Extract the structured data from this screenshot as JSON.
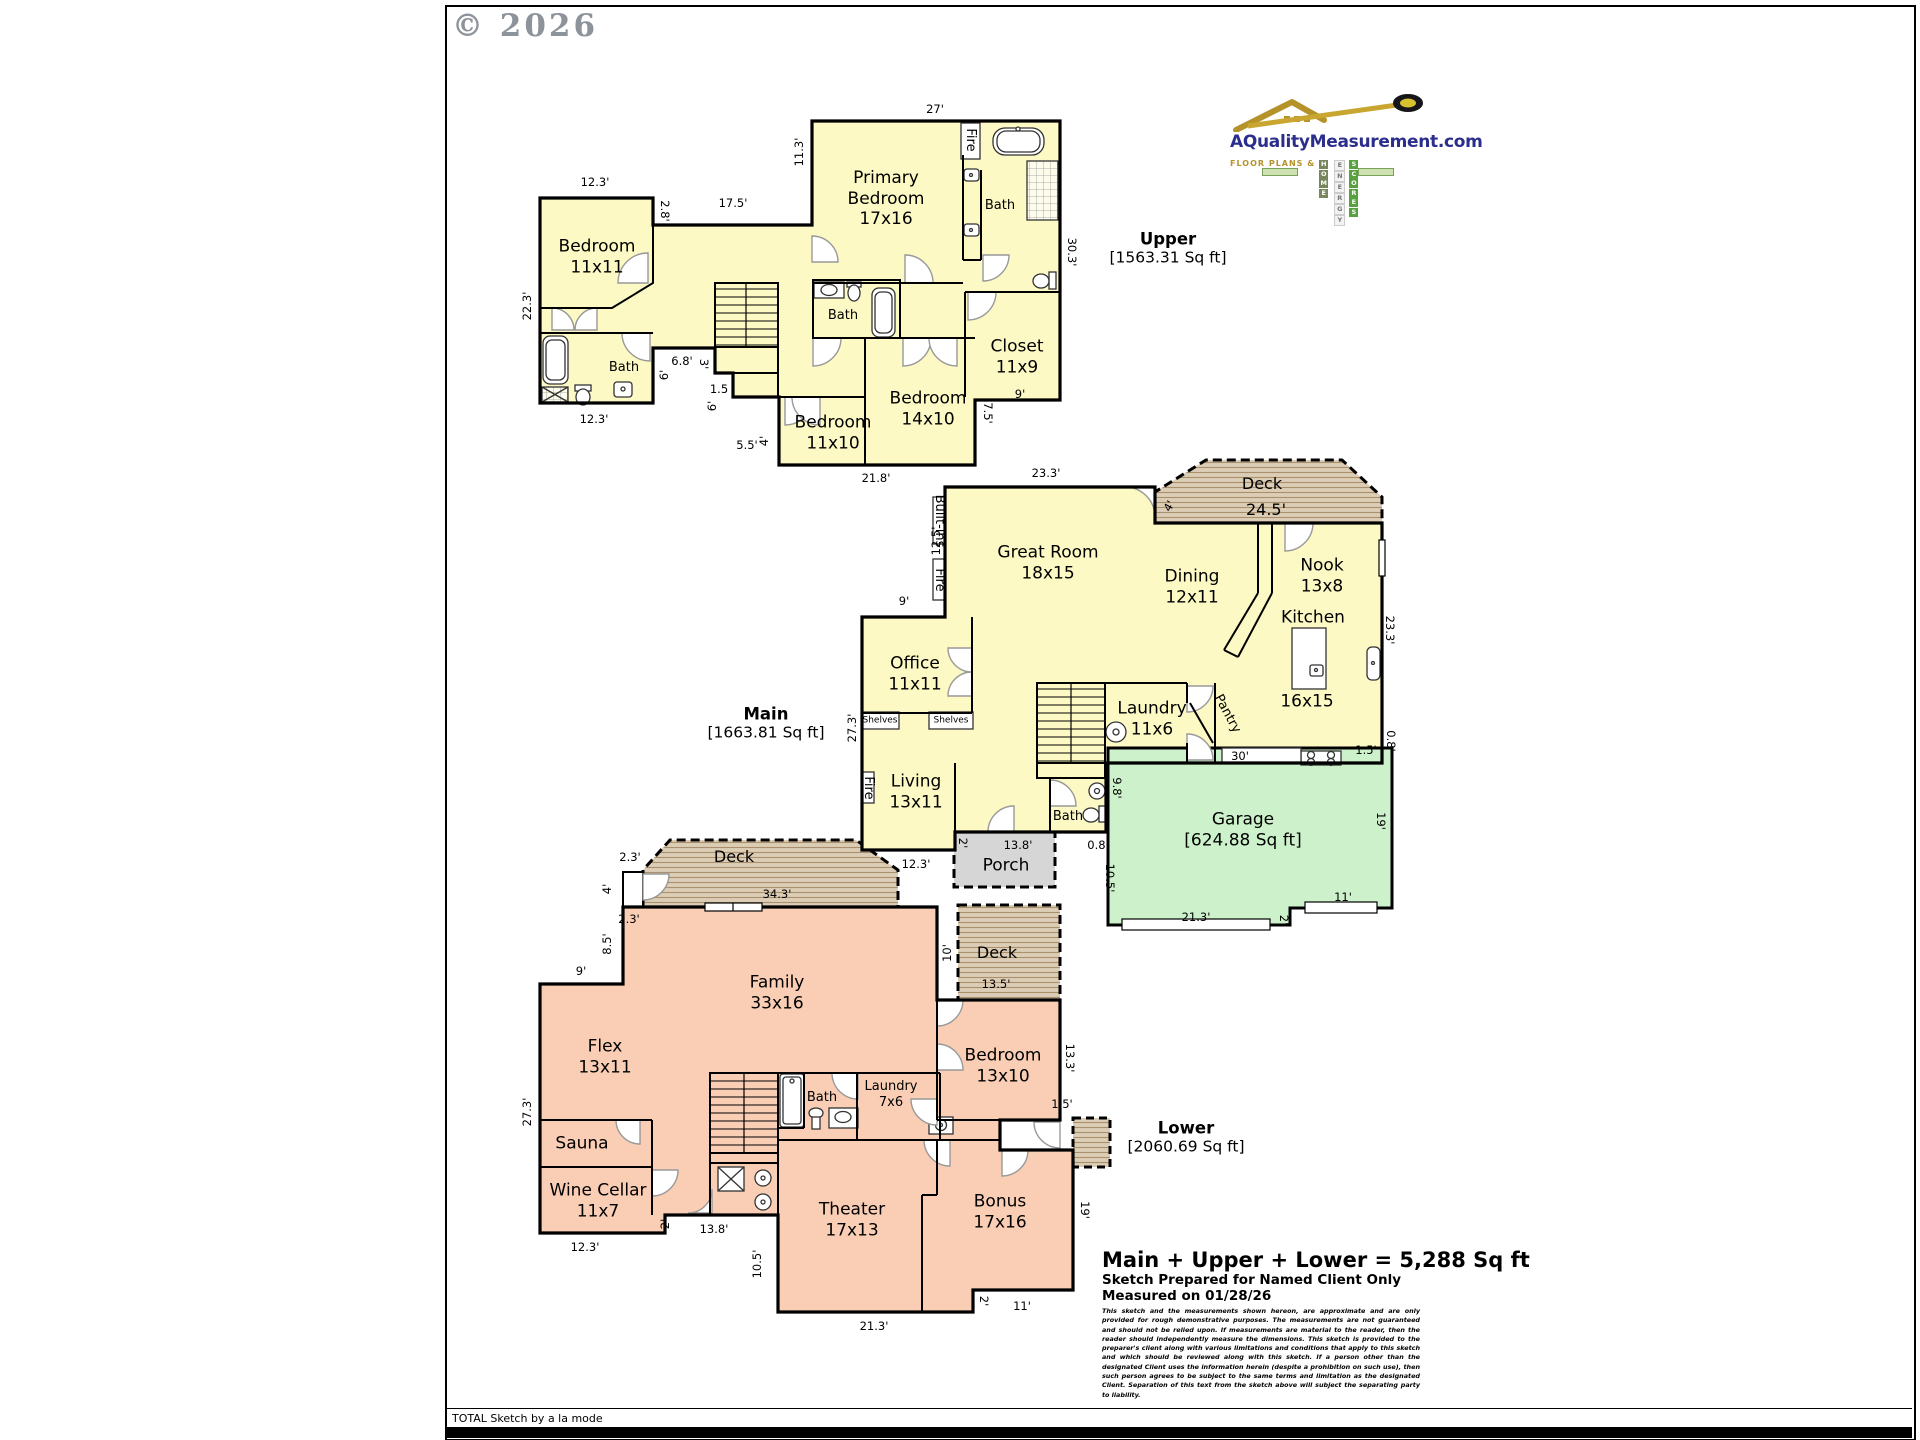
{
  "page": {
    "copyright": "© 2026",
    "footer": "TOTAL Sketch by a la mode"
  },
  "logo": {
    "domain": "AQualityMeasurement.com",
    "tagline": "Floor Plans &",
    "words": [
      "Home",
      "Energy",
      "Scores"
    ]
  },
  "floors": [
    {
      "name": "Upper",
      "area": "[1563.31 Sq ft]"
    },
    {
      "name": "Main",
      "area": "[1663.81 Sq ft]"
    },
    {
      "name": "Lower",
      "area": "[2060.69 Sq ft]"
    }
  ],
  "summary": {
    "total": "Main + Upper + Lower = 5,288 Sq ft",
    "prepared": "Sketch Prepared for Named Client Only",
    "measured": "Measured on 01/28/26",
    "disclaimer": "This sketch and the measurements shown hereon, are approximate and are only provided for rough demonstrative purposes.  The measurements are not guaranteed and should not be relied upon.  If measurements are material to the reader, then the reader should independently measure the dimensions.  This sketch is provided to the preparer's client along with various limitations and conditions that apply to this sketch and which should be reviewed along with this sketch.  If a person other than the designated Client uses the information herein (despite a prohibition on such use), then such person agrees to be subject to the same terms and limitation as the designated Client.  Separation of this text from the sketch above will subject the separating party to liability."
  },
  "colors": {
    "upper_main_fill": "#FCF9C4",
    "lower_fill": "#F9CEB5",
    "garage_fill": "#CDF2CB",
    "porch_fill": "#D6D6D6",
    "deck_fill": "#DCCDB6"
  },
  "labels": {
    "rooms": [
      {
        "t": "Bedroom\n11x11",
        "x": 597,
        "y": 257
      },
      {
        "t": "Primary\nBedroom\n17x16",
        "x": 886,
        "y": 199
      },
      {
        "t": "Closet\n11x9",
        "x": 1017,
        "y": 357
      },
      {
        "t": "Bedroom\n14x10",
        "x": 928,
        "y": 409
      },
      {
        "t": "Bedroom\n11x10",
        "x": 833,
        "y": 433
      },
      {
        "t": "Great Room\n18x15",
        "x": 1048,
        "y": 563
      },
      {
        "t": "Dining\n12x11",
        "x": 1192,
        "y": 587
      },
      {
        "t": "Nook\n13x8",
        "x": 1322,
        "y": 576
      },
      {
        "t": "Kitchen",
        "x": 1313,
        "y": 618
      },
      {
        "t": "16x15",
        "x": 1307,
        "y": 702
      },
      {
        "t": "Office\n11x11",
        "x": 915,
        "y": 674
      },
      {
        "t": "Laundry\n11x6",
        "x": 1152,
        "y": 719
      },
      {
        "t": "Living\n13x11",
        "x": 916,
        "y": 792
      },
      {
        "t": "Garage\n[624.88 Sq ft]",
        "x": 1243,
        "y": 830
      },
      {
        "t": "Family\n33x16",
        "x": 777,
        "y": 993
      },
      {
        "t": "Flex\n13x11",
        "x": 605,
        "y": 1057
      },
      {
        "t": "Sauna",
        "x": 582,
        "y": 1144
      },
      {
        "t": "Wine Cellar\n11x7",
        "x": 598,
        "y": 1201
      },
      {
        "t": "Theater\n17x13",
        "x": 852,
        "y": 1220
      },
      {
        "t": "Bonus\n17x16",
        "x": 1000,
        "y": 1212
      },
      {
        "t": "Bedroom\n13x10",
        "x": 1003,
        "y": 1066
      },
      {
        "t": "Deck",
        "x": 1262,
        "y": 484,
        "cls": "deckl"
      },
      {
        "t": "24.5'",
        "x": 1266,
        "y": 510,
        "cls": "deckl"
      },
      {
        "t": "Deck",
        "x": 734,
        "y": 857,
        "cls": "deckl"
      },
      {
        "t": "Deck",
        "x": 997,
        "y": 953,
        "cls": "deckl"
      },
      {
        "t": "Porch",
        "x": 1006,
        "y": 866
      }
    ],
    "feats": [
      {
        "t": "Bath",
        "x": 624,
        "y": 368
      },
      {
        "t": "Bath",
        "x": 843,
        "y": 316
      },
      {
        "t": "Bath",
        "x": 1000,
        "y": 206
      },
      {
        "t": "Bath",
        "x": 1068,
        "y": 817
      },
      {
        "t": "Bath",
        "x": 822,
        "y": 1098
      },
      {
        "t": "Laundry\n7x6",
        "x": 891,
        "y": 1095
      },
      {
        "t": "Fire",
        "x": 970,
        "y": 140,
        "r": 90
      },
      {
        "t": "Fire",
        "x": 939,
        "y": 580,
        "r": 90
      },
      {
        "t": "Fire",
        "x": 868,
        "y": 788,
        "r": 90
      },
      {
        "t": "Built-ins",
        "x": 939,
        "y": 521,
        "r": 90
      },
      {
        "t": "Pantry",
        "x": 1227,
        "y": 714,
        "r": 62
      },
      {
        "t": "Shelves",
        "x": 880,
        "y": 721,
        "cls": "tiny"
      },
      {
        "t": "Shelves",
        "x": 951,
        "y": 721,
        "cls": "tiny"
      }
    ],
    "dims": [
      {
        "t": "12.3'",
        "x": 595,
        "y": 182
      },
      {
        "t": "2.8'",
        "x": 665,
        "y": 211,
        "r": 90
      },
      {
        "t": "17.5'",
        "x": 733,
        "y": 203
      },
      {
        "t": "11.3'",
        "x": 799,
        "y": 152,
        "r": -90
      },
      {
        "t": "27'",
        "x": 935,
        "y": 109
      },
      {
        "t": "30.3'",
        "x": 1072,
        "y": 252,
        "r": 90
      },
      {
        "t": "22.3'",
        "x": 527,
        "y": 306,
        "r": -90
      },
      {
        "t": "12.3'",
        "x": 594,
        "y": 419
      },
      {
        "t": "6.8'",
        "x": 682,
        "y": 361
      },
      {
        "t": "3'",
        "x": 704,
        "y": 364,
        "r": 90
      },
      {
        "t": "6'",
        "x": 664,
        "y": 375,
        "r": -90
      },
      {
        "t": "1.5",
        "x": 719,
        "y": 389
      },
      {
        "t": "6'",
        "x": 712,
        "y": 406,
        "r": -90
      },
      {
        "t": "5.5'",
        "x": 747,
        "y": 445
      },
      {
        "t": "4'",
        "x": 764,
        "y": 441,
        "r": -90
      },
      {
        "t": "21.8'",
        "x": 876,
        "y": 478
      },
      {
        "t": "9'",
        "x": 1020,
        "y": 394
      },
      {
        "t": "7.5'",
        "x": 988,
        "y": 413,
        "r": 90
      },
      {
        "t": "23.3'",
        "x": 1046,
        "y": 473
      },
      {
        "t": "4'",
        "x": 1169,
        "y": 506,
        "r": -60
      },
      {
        "t": "12.5'",
        "x": 936,
        "y": 541,
        "r": -90
      },
      {
        "t": "9'",
        "x": 904,
        "y": 601
      },
      {
        "t": "27.3'",
        "x": 852,
        "y": 728,
        "r": -90
      },
      {
        "t": "12.3'",
        "x": 916,
        "y": 864
      },
      {
        "t": "2'",
        "x": 963,
        "y": 843,
        "r": 90
      },
      {
        "t": "13.8'",
        "x": 1018,
        "y": 845
      },
      {
        "t": "0.8'",
        "x": 1098,
        "y": 845
      },
      {
        "t": "9.8'",
        "x": 1117,
        "y": 788,
        "r": 90
      },
      {
        "t": "10.5'",
        "x": 1110,
        "y": 878,
        "r": 90
      },
      {
        "t": "21.3'",
        "x": 1196,
        "y": 917
      },
      {
        "t": "2'",
        "x": 1284,
        "y": 920,
        "r": 90
      },
      {
        "t": "11'",
        "x": 1343,
        "y": 897
      },
      {
        "t": "19'",
        "x": 1381,
        "y": 821,
        "r": 90
      },
      {
        "t": "30'",
        "x": 1240,
        "y": 756
      },
      {
        "t": "23.3'",
        "x": 1390,
        "y": 630,
        "r": 90
      },
      {
        "t": "1.5'",
        "x": 1366,
        "y": 750
      },
      {
        "t": "0.8'",
        "x": 1391,
        "y": 741,
        "r": 90
      },
      {
        "t": "2.3'",
        "x": 630,
        "y": 857
      },
      {
        "t": "4'",
        "x": 607,
        "y": 889,
        "r": -90
      },
      {
        "t": "2.3'",
        "x": 629,
        "y": 919
      },
      {
        "t": "8.5'",
        "x": 607,
        "y": 944,
        "r": -90
      },
      {
        "t": "9'",
        "x": 581,
        "y": 971
      },
      {
        "t": "34.3'",
        "x": 777,
        "y": 894
      },
      {
        "t": "27.3'",
        "x": 527,
        "y": 1112,
        "r": -90
      },
      {
        "t": "12.3'",
        "x": 585,
        "y": 1247
      },
      {
        "t": "2'",
        "x": 665,
        "y": 1224,
        "r": -90
      },
      {
        "t": "13.8'",
        "x": 714,
        "y": 1229
      },
      {
        "t": "10.5'",
        "x": 757,
        "y": 1264,
        "r": -90
      },
      {
        "t": "21.3'",
        "x": 874,
        "y": 1326
      },
      {
        "t": "2'",
        "x": 984,
        "y": 1301,
        "r": 90
      },
      {
        "t": "11'",
        "x": 1022,
        "y": 1306
      },
      {
        "t": "19'",
        "x": 1085,
        "y": 1210,
        "r": 90
      },
      {
        "t": "13.3'",
        "x": 1070,
        "y": 1058,
        "r": 90
      },
      {
        "t": "1.5'",
        "x": 1062,
        "y": 1104
      },
      {
        "t": "13.5'",
        "x": 996,
        "y": 984
      },
      {
        "t": "10'",
        "x": 947,
        "y": 953,
        "r": -90
      }
    ]
  }
}
